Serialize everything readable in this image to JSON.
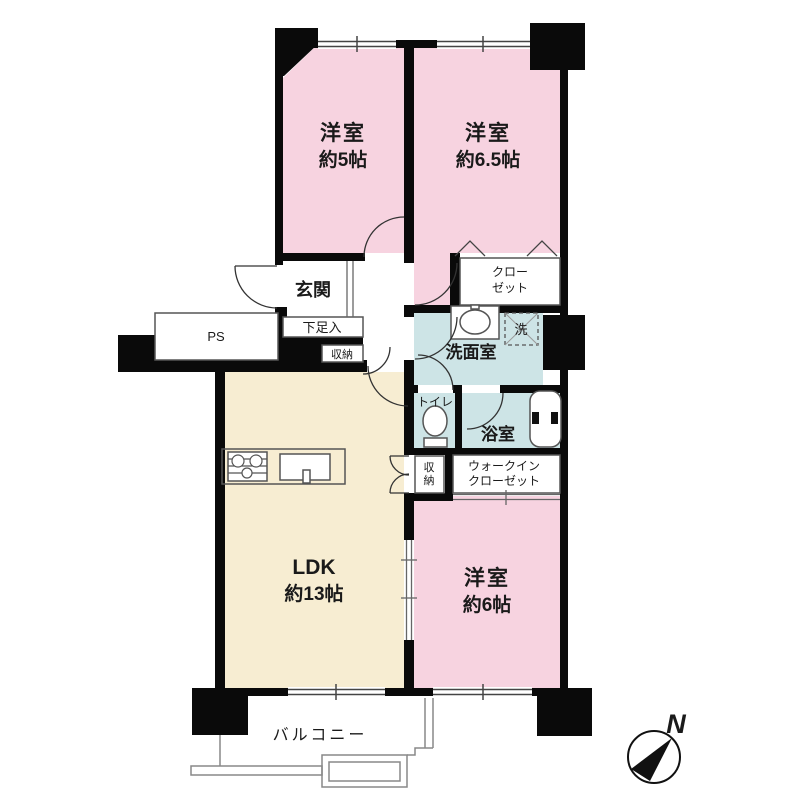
{
  "plan": {
    "rooms": {
      "room1_name": "洋室",
      "room1_size": "約5帖",
      "room2_name": "洋室",
      "room2_size": "約6.5帖",
      "room3_name": "洋室",
      "room3_size": "約6帖",
      "ldk_name": "LDK",
      "ldk_size": "約13帖",
      "genkan": "玄関",
      "washroom": "洗面室",
      "bath": "浴室",
      "toilet": "トイレ",
      "laundry": "洗",
      "closet_l1": "クロー",
      "closet_l2": "ゼット",
      "wic_l1": "ウォークイン",
      "wic_l2": "クローゼット",
      "shoe_box": "下足入",
      "storage_hall": "収納",
      "storage_ldk_l1": "収",
      "storage_ldk_l2": "納",
      "ps": "PS",
      "balcony": "バルコニー"
    },
    "compass": {
      "north": "N"
    },
    "colors": {
      "wall": "#0a0a0a",
      "room_pink": "#f7d3e0",
      "ldk_cream": "#f7edd2",
      "wet_blue": "#cde4e6",
      "thin_line": "#555555",
      "light_line": "#888888"
    }
  }
}
